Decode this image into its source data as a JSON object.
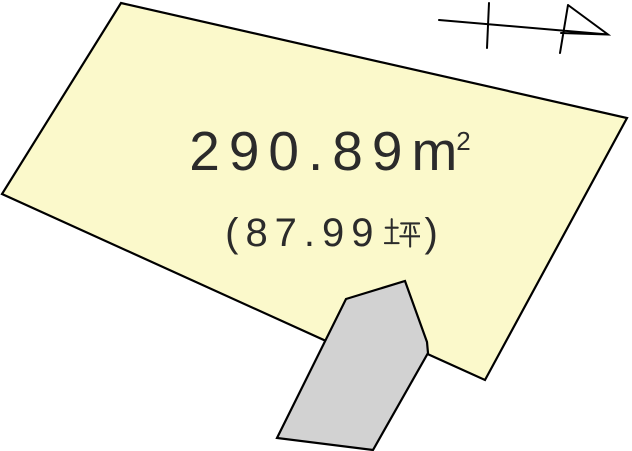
{
  "parcel": {
    "area_sqm": "290.89",
    "unit_base": "m",
    "unit_sup": "2",
    "tsubo_open": "(",
    "area_tsubo": "87.99",
    "tsubo_unit": "坪",
    "tsubo_close": ")"
  },
  "colors": {
    "background": "#FFFFFF",
    "parcel_fill": "#FBF9CB",
    "building_fill": "#D2D2D2",
    "outline": "#000000",
    "text": "#2B2B2B"
  },
  "shapes": {
    "parcel": {
      "points": "121,3 627,118 485,380 412,347 412,380 2,194"
    },
    "building": {
      "points": "405,281 427,342 428,353 373,450 277,438 346,299"
    },
    "north_arrow": {
      "d": "M439 20 L608 34.5 M489 3 L487 48 M568 5 L560 53 M568 5 L608 34.5 L561 33"
    }
  }
}
